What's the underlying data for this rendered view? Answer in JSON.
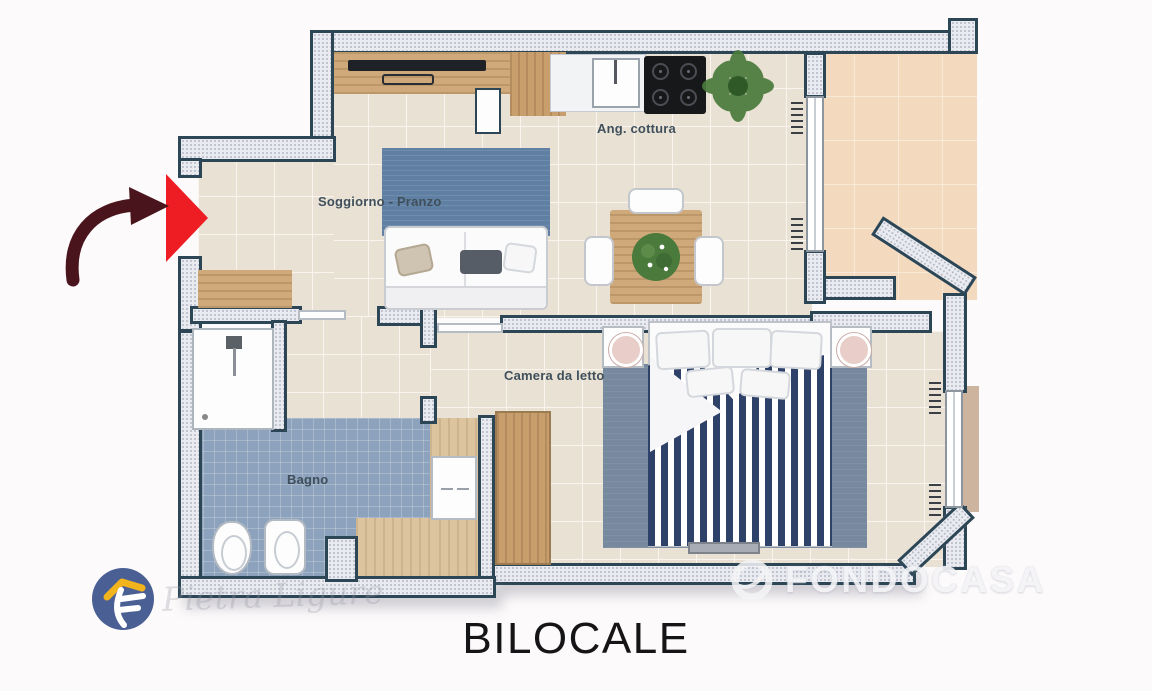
{
  "title": "BILOCALE",
  "rooms": {
    "living": "Soggiorno - Pranzo",
    "kitchen": "Ang. cottura",
    "bedroom": "Camera da letto",
    "bathroom": "Bagno"
  },
  "watermarks": {
    "agency": "FONDOCASA",
    "script": "Pietra Ligure"
  },
  "colors": {
    "wall_outline": "#2c4656",
    "wall_fill": "#e9ebf0",
    "floor_tile": "#e9e1d4",
    "bath_tile": "#8da2bc",
    "balcony_floor": "#f3d9be",
    "wood": "#cfa97a",
    "sofa_rug": "#5f7fa3",
    "bed_rug": "#77899e",
    "duvet_stripe": "#2e4169",
    "entrance_marker_red": "#ee1c23",
    "arrow_maroon": "#4a141d",
    "logo_blue": "#4a5f94",
    "logo_yellow": "#f2b41c"
  }
}
